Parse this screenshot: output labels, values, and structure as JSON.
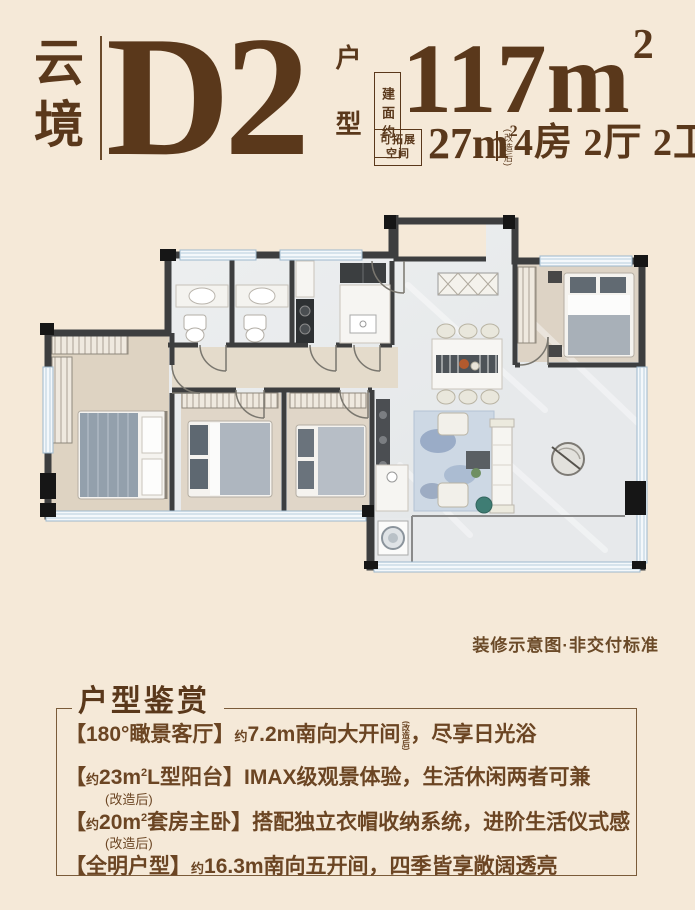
{
  "colors": {
    "background": "#f5e9d8",
    "accent_brown": "#5a381b",
    "body_brown": "#6b4523",
    "wall_dark": "#3d3e3f",
    "window_blue": "#9db8cd"
  },
  "header": {
    "brand": "云境",
    "plan_code": "D2",
    "plan_type": "户型",
    "area_tag": "建面约",
    "area_value": "117m",
    "area_sup": "2",
    "expand_tag_line1": "可拓展",
    "expand_tag_line2": "空间",
    "expand_value": "27m",
    "expand_sup": "2",
    "renovate_note": "(改造后)",
    "layout_text": "4房 2厅 2卫"
  },
  "floorplan": {
    "caption": "装修示意图·非交付标准"
  },
  "highlights": {
    "title": "户型鉴赏",
    "items": [
      {
        "open": "【",
        "head_text": "180°瞰景客厅",
        "close": "】",
        "body_approx": "约",
        "body_main": "7.2m南向大开间",
        "note_inline": "(改造后)",
        "body_tail": "，尽享日光浴"
      },
      {
        "open": "【",
        "head_approx": "约",
        "head_value": "23m",
        "head_sup": "2",
        "head_text": "L型阳台",
        "close": "】",
        "body_main": "IMAX级观景体验，生活休闲两者可兼",
        "note_below": "(改造后)"
      },
      {
        "open": "【",
        "head_approx": "约",
        "head_value": "20m",
        "head_sup": "2",
        "head_text": "套房主卧",
        "close": "】",
        "body_main": "搭配独立衣帽收纳系统，进阶生活仪式感",
        "note_below": "(改造后)"
      },
      {
        "open": "【",
        "head_text": "全明户型",
        "close": "】",
        "body_approx": "约",
        "body_main": "16.3m南向五开间，四季皆享敞阔透亮"
      }
    ]
  }
}
